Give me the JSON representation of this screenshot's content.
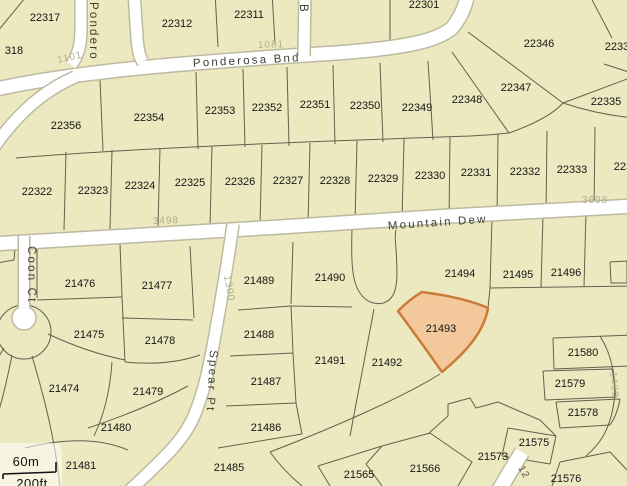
{
  "streets": {
    "ponderosa_bnd": "Ponderosa Bnd",
    "mountain_dew": "Mountain Dew",
    "coon_ct": "Coon Ct",
    "spear_pt": "Spear Pt",
    "ponderosa_vertical": "Pondero",
    "b_street": "B"
  },
  "address_markers": {
    "a1101": "1101",
    "a1081": "1081",
    "a3498": "3498",
    "a3698": "3698",
    "a1300": "1300",
    "a1400": "1400",
    "a12": "12"
  },
  "selected_parcel": {
    "id": "21493"
  },
  "parcels": [
    {
      "id": "22317"
    },
    {
      "id": "318"
    },
    {
      "id": "22312"
    },
    {
      "id": "22311"
    },
    {
      "id": "22301"
    },
    {
      "id": "22346"
    },
    {
      "id": "22336"
    },
    {
      "id": "22347"
    },
    {
      "id": "22335"
    },
    {
      "id": "22356"
    },
    {
      "id": "22354"
    },
    {
      "id": "22353"
    },
    {
      "id": "22352"
    },
    {
      "id": "22351"
    },
    {
      "id": "22350"
    },
    {
      "id": "22349"
    },
    {
      "id": "22348"
    },
    {
      "id": "22322"
    },
    {
      "id": "22323"
    },
    {
      "id": "22324"
    },
    {
      "id": "22325"
    },
    {
      "id": "22326"
    },
    {
      "id": "22327"
    },
    {
      "id": "22328"
    },
    {
      "id": "22329"
    },
    {
      "id": "22330"
    },
    {
      "id": "22331"
    },
    {
      "id": "22332"
    },
    {
      "id": "22333"
    },
    {
      "id": "22334"
    },
    {
      "id": "21476"
    },
    {
      "id": "21477"
    },
    {
      "id": "21489"
    },
    {
      "id": "21490"
    },
    {
      "id": "21494"
    },
    {
      "id": "21495"
    },
    {
      "id": "21496"
    },
    {
      "id": "21475"
    },
    {
      "id": "21478"
    },
    {
      "id": "21488"
    },
    {
      "id": "21580"
    },
    {
      "id": "21491"
    },
    {
      "id": "21492"
    },
    {
      "id": "21474"
    },
    {
      "id": "21479"
    },
    {
      "id": "21487"
    },
    {
      "id": "21579"
    },
    {
      "id": "21480"
    },
    {
      "id": "21486"
    },
    {
      "id": "21578"
    },
    {
      "id": "21575"
    },
    {
      "id": "21481"
    },
    {
      "id": "21485"
    },
    {
      "id": "21573"
    },
    {
      "id": "21566"
    },
    {
      "id": "21565"
    },
    {
      "id": "21576"
    }
  ],
  "scale_bar": {
    "metric": "60m",
    "imperial": "200ft"
  },
  "colors": {
    "parcel_fill": "#ece8bf",
    "road_fill": "#ffffff",
    "lot_line": "#62614d",
    "selected_fill": "#f3c99c",
    "selected_border": "#cb7c38"
  }
}
